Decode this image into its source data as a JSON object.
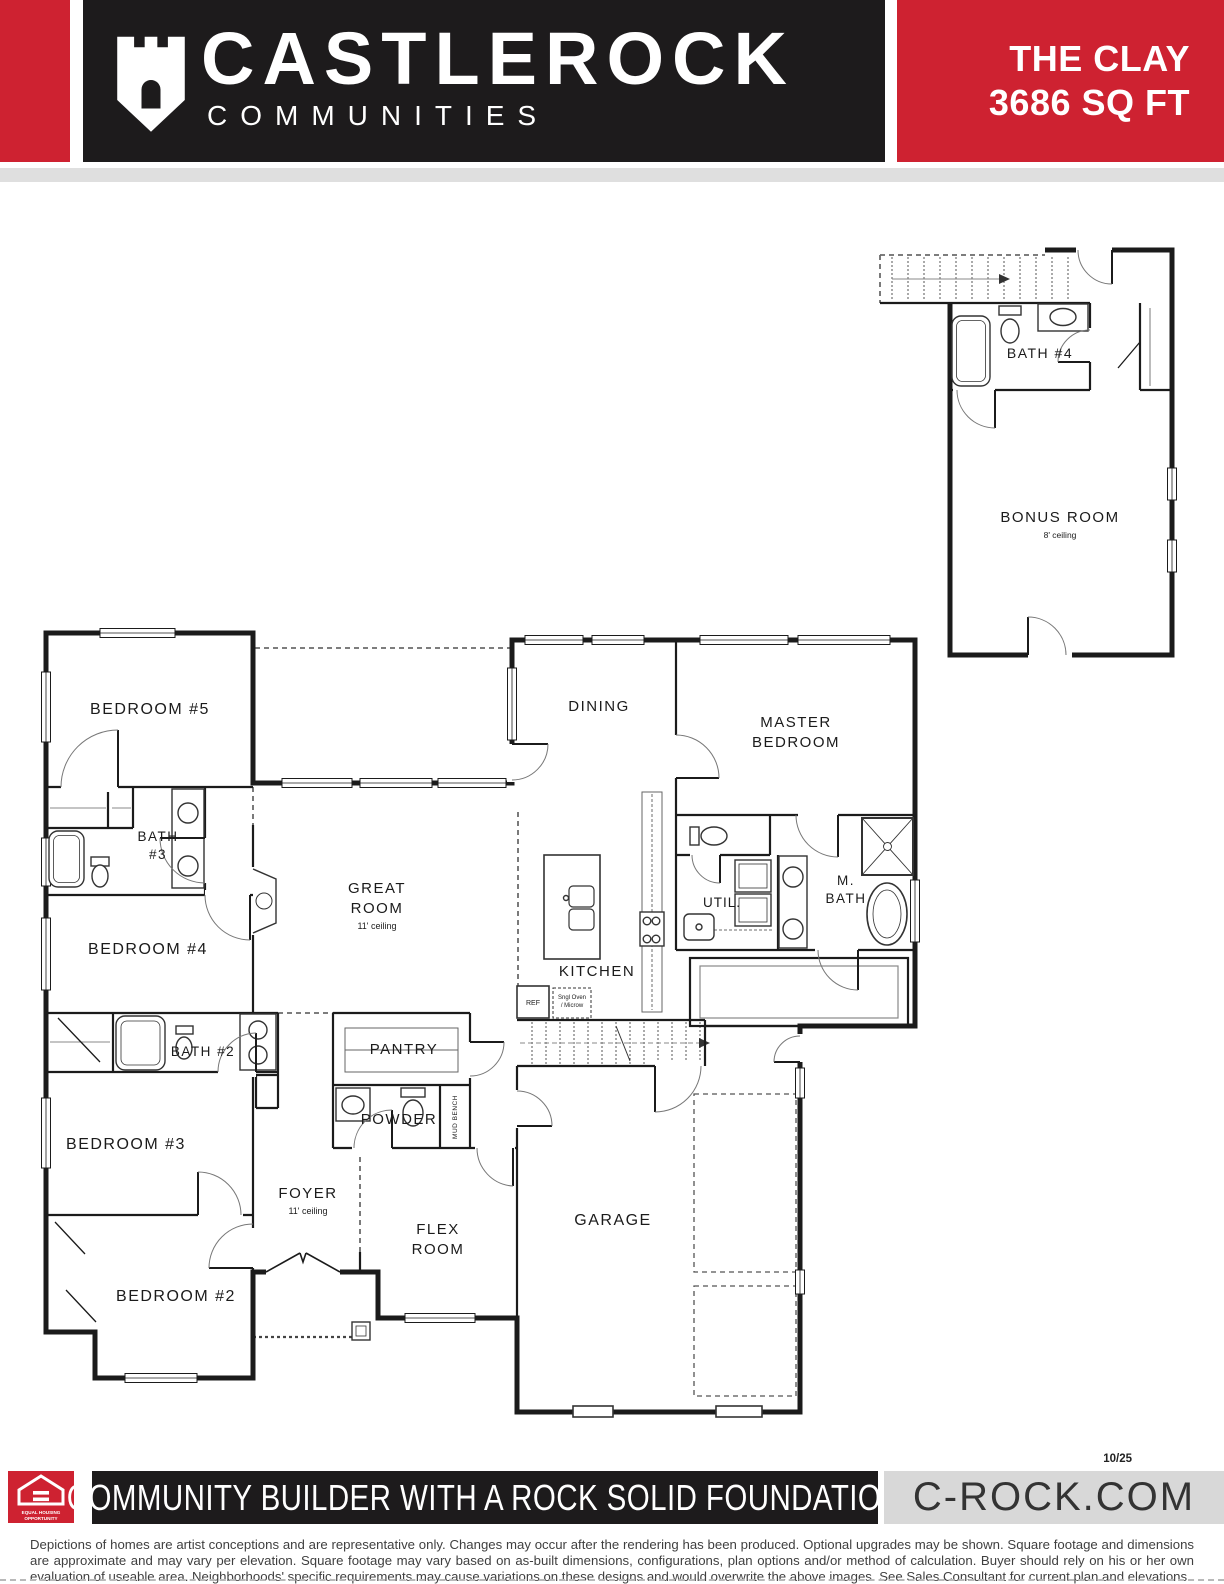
{
  "header": {
    "brand_name": "CASTLEROCK",
    "brand_sub": "COMMUNITIES",
    "plan_name": "THE CLAY",
    "plan_sqft": "3686 SQ FT"
  },
  "colors": {
    "brand_red": "#CE2231",
    "logo_black": "#1D1B1C",
    "footer_gray": "#D8D8D8",
    "wall_ink": "#1b1b1b"
  },
  "floorplan": {
    "labels": {
      "bedroom5": "BEDROOM #5",
      "bath3_1": "BATH",
      "bath3_2": "#3",
      "bedroom4": "BEDROOM #4",
      "bath2": "BATH #2",
      "bedroom3": "BEDROOM #3",
      "bedroom2": "BEDROOM #2",
      "foyer": "FOYER",
      "foyer_sub": "11' ceiling",
      "flex_1": "FLEX",
      "flex_2": "ROOM",
      "pantry": "PANTRY",
      "powder": "POWDER",
      "mud_bench": "MUD BENCH",
      "great_1": "GREAT",
      "great_2": "ROOM",
      "great_sub": "11' ceiling",
      "dining": "DINING",
      "kitchen": "KITCHEN",
      "garage": "GARAGE",
      "master_1": "MASTER",
      "master_2": "BEDROOM",
      "mbath_1": "M.",
      "mbath_2": "BATH",
      "util": "UTIL.",
      "ref": "REF",
      "oven_1": "Sngl Oven",
      "oven_2": "/ Microw",
      "bath4": "BATH #4",
      "bonus": "BONUS ROOM",
      "bonus_sub": "8' ceiling"
    }
  },
  "footer": {
    "date_code": "10/25",
    "tagline": "COMMUNITY BUILDER WITH A ROCK SOLID FOUNDATION",
    "website": "C-ROCK.COM",
    "eho_1": "EQUAL HOUSING",
    "eho_2": "OPPORTUNITY",
    "disclaimer": "Depictions of homes are artist conceptions and are representative only. Changes may occur after the rendering has been produced. Optional upgrades may be shown. Square footage and dimensions are approximate and may vary per elevation. Square footage may vary based on as-built dimensions, configurations, plan options and/or method of calculation. Buyer should rely on his or her own evaluation of useable area. Neighborhoods' specific requirements may cause variations on these designs and would overwrite the above images. See Sales Consultant for current plan and elevations."
  }
}
